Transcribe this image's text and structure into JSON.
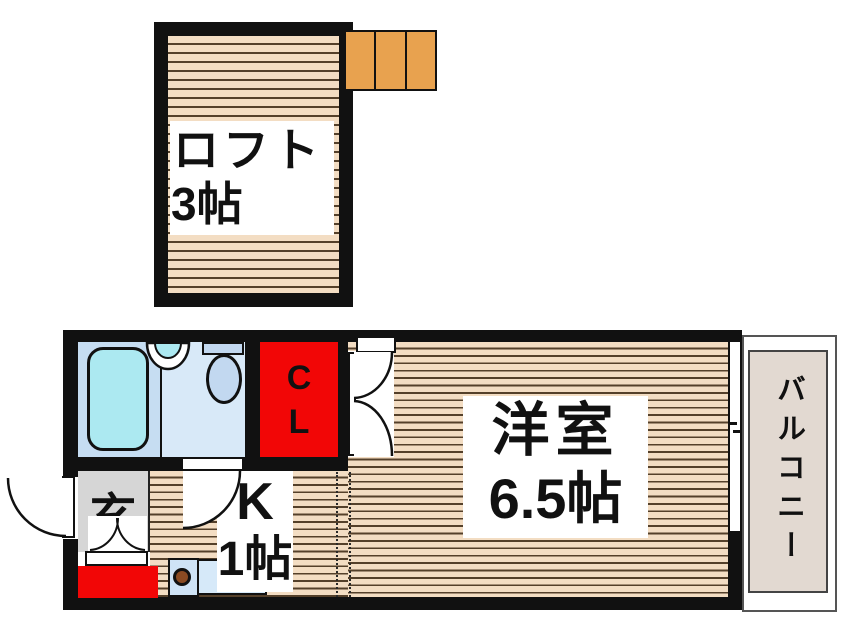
{
  "title": "1K apartment floor plan with loft",
  "rooms": {
    "loft": {
      "name": "ロフト",
      "size": "3帖"
    },
    "western_room": {
      "name": "洋室",
      "size": "6.5帖"
    },
    "kitchen": {
      "name": "K",
      "size": "1帖"
    },
    "closet": {
      "line1": "C",
      "line2": "L"
    },
    "entrance": {
      "label": "玄"
    },
    "balcony": {
      "label": "バルコニー"
    }
  },
  "colors": {
    "wall": "#111111",
    "floor_stripe_fill": "#f3ddc3",
    "floor_stripe_line": "#54402a",
    "closet_red": "#f20606",
    "entrance_gray": "#d6d6d6",
    "stairs_orange": "#e8a24f",
    "balcony_beige": "#e2d9d1",
    "bath_floor_left": "#c6ddf2",
    "bath_floor_right": "#d8e9f8",
    "bathtub_cyan": "#ace9f1",
    "fixture_blue": "#c2d8f0",
    "counter_blue": "#cfe3f6",
    "burner_brown": "#8a4a22"
  }
}
